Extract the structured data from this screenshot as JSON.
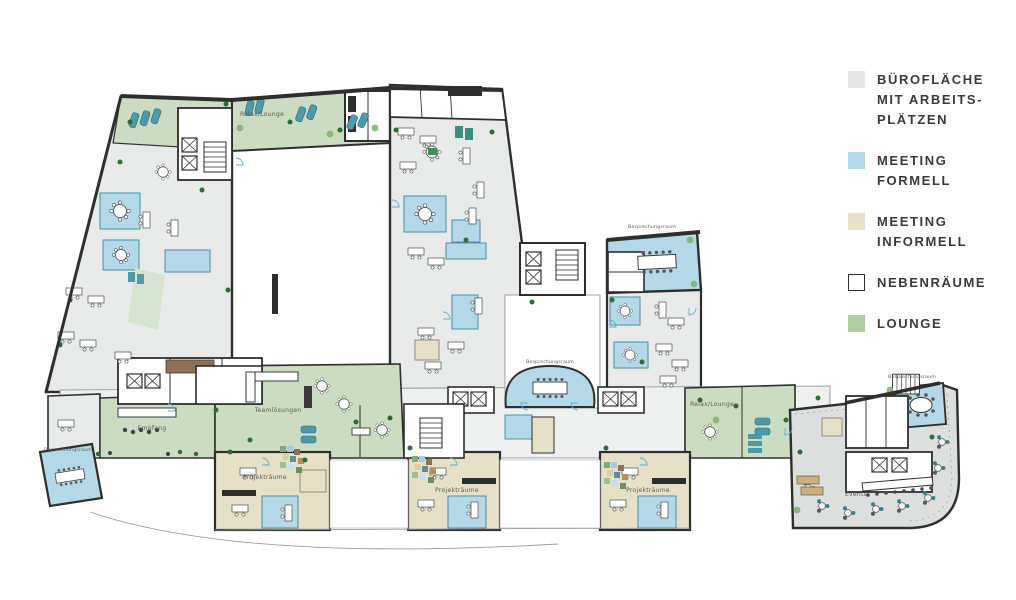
{
  "legend": {
    "items": [
      {
        "id": "bueroflaeche",
        "swatch_color": "#e3e6e2",
        "lines": [
          "BÜROFLÄCHE",
          "MIT ARBEITS-",
          "PLÄTZEN"
        ]
      },
      {
        "id": "meeting_formell",
        "swatch_color": "#b5d8e6",
        "lines": [
          "MEETING",
          "FORMELL"
        ]
      },
      {
        "id": "meeting_informell",
        "swatch_color": "#e7e0c8",
        "lines": [
          "MEETING",
          "INFORMELL"
        ]
      },
      {
        "id": "nebenraeume",
        "swatch_color": "#ffffff",
        "swatch_border": "#2e2e2e",
        "lines": [
          "NEBENRÄUME"
        ]
      },
      {
        "id": "lounge",
        "swatch_color": "#aecfa2",
        "lines": [
          "LOUNGE"
        ]
      }
    ]
  },
  "plan": {
    "labels": {
      "relax_lounge_top": "Relax/Lounge",
      "relax_lounge_right": "Relax/Lounge",
      "empfang": "Empfang",
      "teamloesungen": "Teamlösungen",
      "projektraeume_1": "Projekträume",
      "projektraeume_2": "Projekträume",
      "projektraeume_3": "Projekträume",
      "events": "Events",
      "besprechungsraum_north": "Besprechungsraum",
      "besprechungsraum_center": "Besprechungsraum",
      "besprechungsraum_events": "Besprechungsraum",
      "besprechungsraum_southwest": "Besprechungsraum"
    },
    "colors": {
      "office": "#e8eae9",
      "meeting_formell": "#b5d8e6",
      "meeting_informell": "#e7e0c8",
      "nebenraeume": "#ffffff",
      "lounge": "#cbdcc3",
      "events_floor": "#dcdfdd",
      "wall": "#2e2e2e",
      "plant": "#2f6b38",
      "teal_furniture": "#4d9aa8",
      "wood": "#8d7258"
    }
  }
}
